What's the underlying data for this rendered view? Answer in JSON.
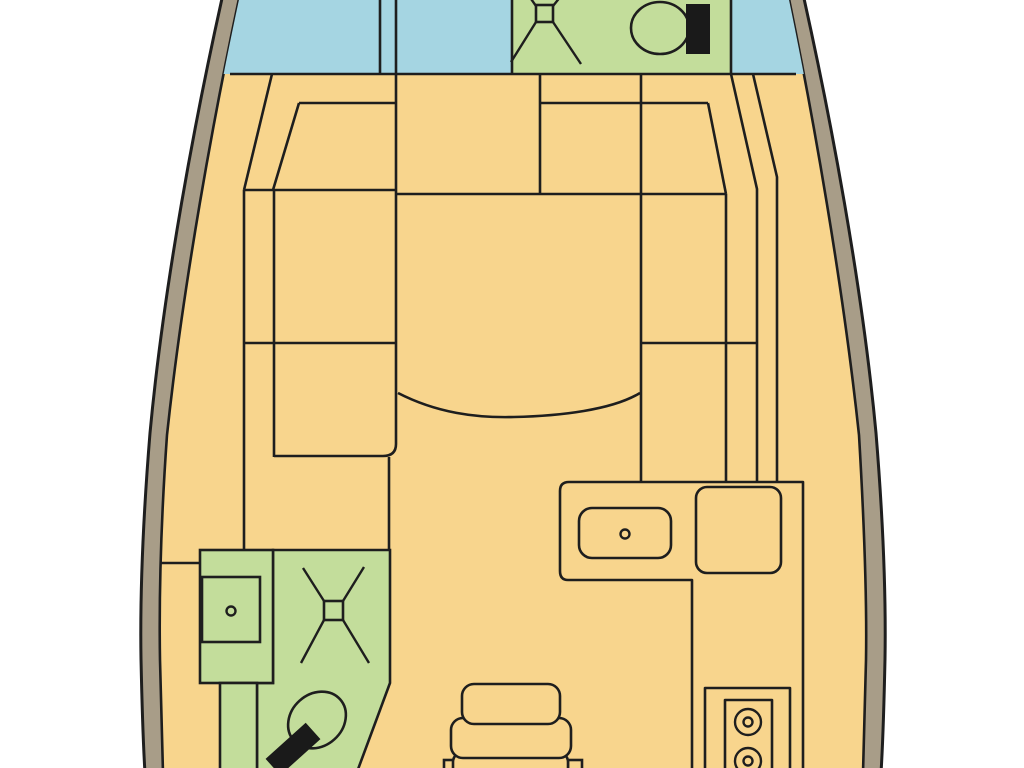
{
  "colors": {
    "background": "#ffffff",
    "hull_band": "#a89d88",
    "outline": "#1e1e1e",
    "floor": "#f8d58d",
    "wet_area": "#c3dd9b",
    "berth": "#a5d5e2",
    "fixture_black": "#1a1a1a"
  },
  "regions": {
    "bow_berth": "bow berth",
    "bow_head": "forward head with shower and toilet",
    "salon_left_settee": "left U-settee",
    "salon_table": "dinette table",
    "salon_right_settee": "right settee",
    "galley": "galley counter with sink and stove",
    "aft_head": "lower head with sink, shower and toilet",
    "companionway_steps": "companionway steps"
  }
}
